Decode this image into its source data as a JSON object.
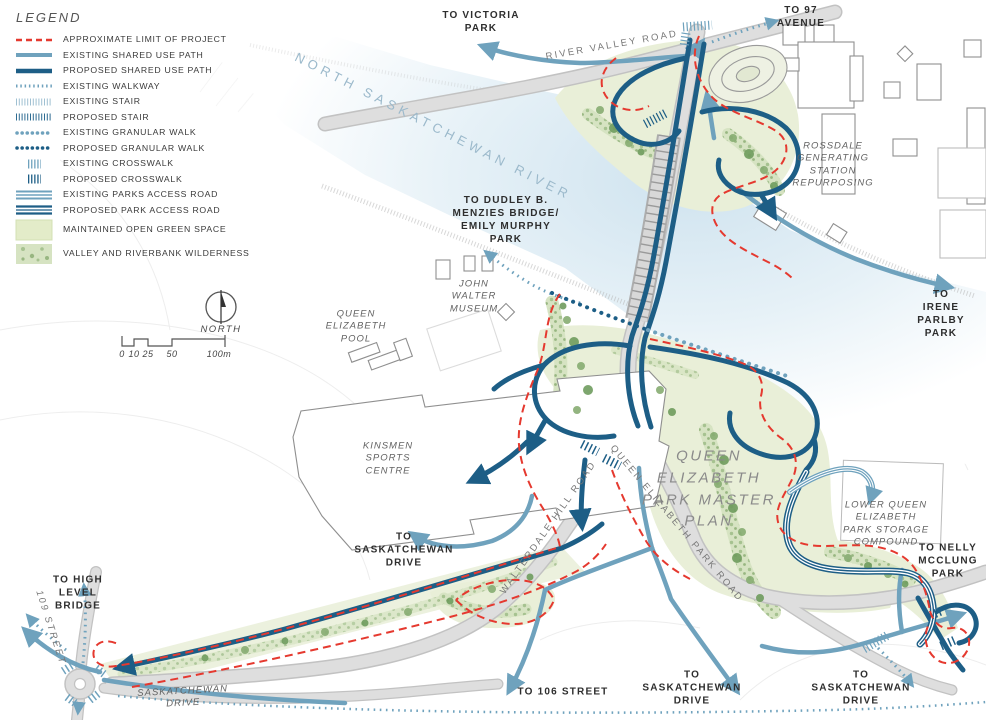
{
  "legend": {
    "title": "LEGEND",
    "items": [
      {
        "label": "APPROXIMATE LIMIT OF PROJECT",
        "type": "red-dashed-line"
      },
      {
        "label": "EXISTING SHARED USE PATH",
        "type": "light-blue-solid-line"
      },
      {
        "label": "PROPOSED SHARED USE PATH",
        "type": "dark-blue-solid-line"
      },
      {
        "label": "EXISTING WALKWAY",
        "type": "light-blue-dotted-line"
      },
      {
        "label": "EXISTING STAIR",
        "type": "light-blue-hatch-line"
      },
      {
        "label": "PROPOSED STAIR",
        "type": "dark-blue-hatch-line"
      },
      {
        "label": "EXISTING GRANULAR WALK",
        "type": "light-blue-round-dots"
      },
      {
        "label": "PROPOSED GRANULAR WALK",
        "type": "dark-blue-round-dots"
      },
      {
        "label": "EXISTING CROSSWALK",
        "type": "light-blue-crosswalk-bars"
      },
      {
        "label": "PROPOSED CROSSWALK",
        "type": "dark-blue-crosswalk-bars"
      },
      {
        "label": "EXISTING PARKS ACCESS ROAD",
        "type": "light-blue-triple-line"
      },
      {
        "label": "PROPOSED PARK ACCESS ROAD",
        "type": "dark-blue-triple-line"
      },
      {
        "label": "MAINTAINED OPEN GREEN SPACE",
        "type": "green-swatch"
      },
      {
        "label": "VALLEY AND RIVERBANK WILDERNESS",
        "type": "textured-green-swatch"
      }
    ]
  },
  "map_labels": {
    "to_victoria_park": "TO VICTORIA\nPARK",
    "to_97_avenue": "TO 97\nAVENUE",
    "river_valley_road": "RIVER VALLEY ROAD",
    "north_saskatchewan_river": "NORTH SASKATCHEWAN RIVER",
    "rossdale": "ROSSDALE\nGENERATING\nSTATION\nREPURPOSING",
    "to_irene_parlby_park": "TO IRENE\nPARLBY\nPARK",
    "to_dudley_menzies": "TO DUDLEY B.\nMENZIES BRIDGE/\nEMILY MURPHY\nPARK",
    "john_walter_museum": "JOHN\nWALTER\nMUSEUM",
    "queen_elizabeth_pool": "QUEEN\nELIZABETH\nPOOL",
    "kinsmen_sports_centre": "KINSMEN\nSPORTS\nCENTRE",
    "qep_master_plan": "QUEEN\nELIZABETH\nPARK MASTER\nPLAN",
    "walterdale_hill_road": "WALTERDALE HILL ROAD",
    "queen_elizabeth_park_road": "QUEEN ELIZABETH PARK ROAD",
    "lower_qep_storage": "LOWER QUEEN\nELIZABETH\nPARK STORAGE\nCOMPOUND",
    "to_nelly_mcclung_park": "TO NELLY\nMCCLUNG\nPARK",
    "to_high_level_bridge": "TO HIGH\nLEVEL\nBRIDGE",
    "street_109": "109 STREET",
    "saskatchewan_drive": "SASKATCHEWAN\nDRIVE",
    "to_106_street": "TO 106 STREET",
    "to_saskatchewan_drive_west": "TO\nSASKATCHEWAN\nDRIVE",
    "to_saskatchewan_drive_south": "TO\nSASKATCHEWAN\nDRIVE",
    "to_saskatchewan_drive_east": "TO\nSASKATCHEWAN\nDRIVE",
    "north": "NORTH"
  },
  "scale_bar": {
    "ticks": [
      "0",
      "10",
      "25",
      "50",
      "100m"
    ]
  },
  "colors": {
    "existing_path_blue": "#6FA2BD",
    "proposed_path_blue": "#1D5E86",
    "project_limit_red": "#E5392F",
    "water_tint": "#CFE3EF",
    "maintained_green": "#E9EFD8",
    "wilderness_green": "#D6E3C2",
    "road_gray": "#DEDEDE",
    "river_label_blue": "#9BB9CB"
  }
}
